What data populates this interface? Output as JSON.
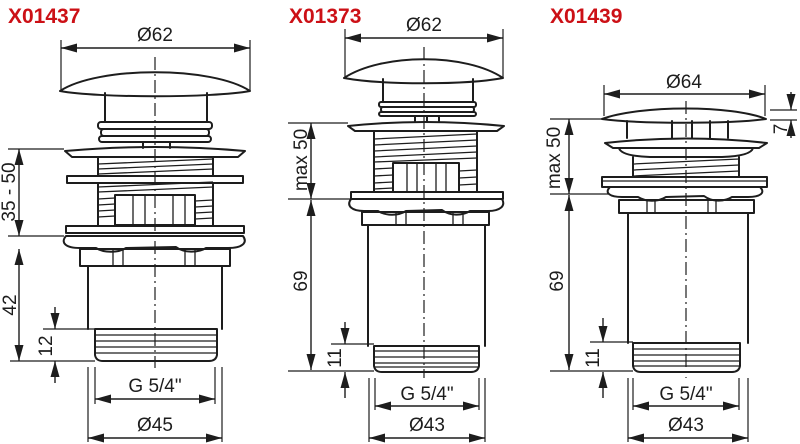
{
  "page": {
    "background": "#ffffff",
    "line_color": "#1d1d1d",
    "accent_red": "#cc1016"
  },
  "diagrams": [
    {
      "part_number": "X01437",
      "dimensions": {
        "cap_diameter": "Ø62",
        "clamp_range": "35 - 50",
        "body_below": "42",
        "thread_length": "12",
        "thread_size": "G 5/4\"",
        "outlet_diameter": "Ø45"
      }
    },
    {
      "part_number": "X01373",
      "dimensions": {
        "cap_diameter": "Ø62",
        "clamp_range": "max 50",
        "body_height": "69",
        "thread_length": "11",
        "thread_size": "G 5/4\"",
        "outlet_diameter": "Ø43"
      }
    },
    {
      "part_number": "X01439",
      "dimensions": {
        "cap_diameter": "Ø64",
        "cap_height": "7",
        "clamp_range": "max 50",
        "body_height": "69",
        "thread_length": "11",
        "thread_size": "G 5/4\"",
        "outlet_diameter": "Ø43"
      }
    }
  ]
}
